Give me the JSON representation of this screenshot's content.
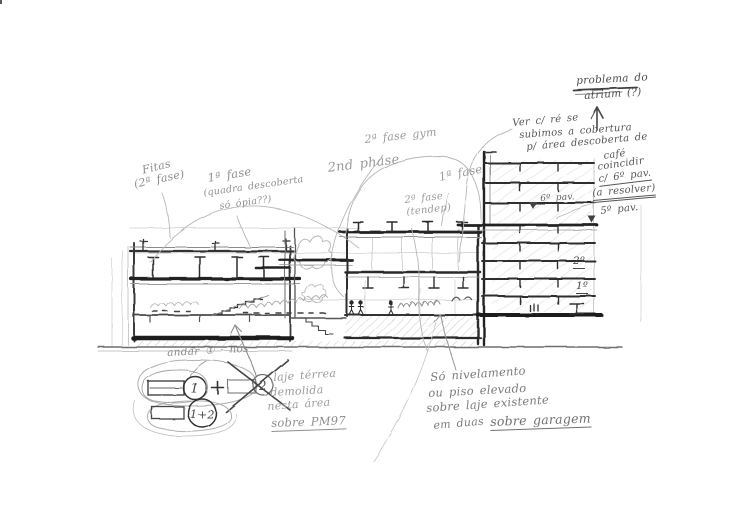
{
  "sketch": {
    "title": "architectural section sketch (pencil)",
    "colors": {
      "paper": "#ffffff",
      "pencil_dark": "#2e2e2e",
      "pencil_mid": "#6e6e6e",
      "pencil_light": "#b3b3b3"
    }
  },
  "annotations": {
    "atrium_problem": {
      "lines": [
        "problema do",
        "atrium (?)"
      ]
    },
    "roof_note": {
      "lines": [
        "Ver c/ ré se",
        "subimos a cobertura",
        "p/ área descoberta de"
      ]
    },
    "cafe_note": {
      "lines": [
        "café",
        "coincidir",
        "c/ 6º pav.",
        "(a resolver)"
      ]
    },
    "levels": {
      "pav6": "6º pav.",
      "pav5": "5º pav.",
      "floor2": "2º",
      "floor1": "1º"
    },
    "phases": {
      "fitas": [
        "Fitas",
        "(2ª fase)"
      ],
      "fase1_quadra": [
        "1ª fase",
        "(quadra descoberta",
        "só ópia??)"
      ],
      "phase2_en": "2nd phase",
      "fase2_gym": "2ª fase gym",
      "fase1": "1ª fase",
      "fase2_tendep": [
        "2ª fase",
        "(tendep)"
      ]
    },
    "floor_diagram": {
      "caption": "andar ① · nós",
      "unit1": "1",
      "plus": "+",
      "unit2": "2",
      "combined": "1+2"
    },
    "slab_note": {
      "lines": [
        "laje térrea",
        "demolida",
        "nesta área",
        "sobre PM97"
      ]
    },
    "leveling_note": {
      "lines": [
        "Só nivelamento",
        "ou piso elevado",
        "sobre laje existente",
        "em duas",
        "sobre garagem"
      ]
    }
  }
}
